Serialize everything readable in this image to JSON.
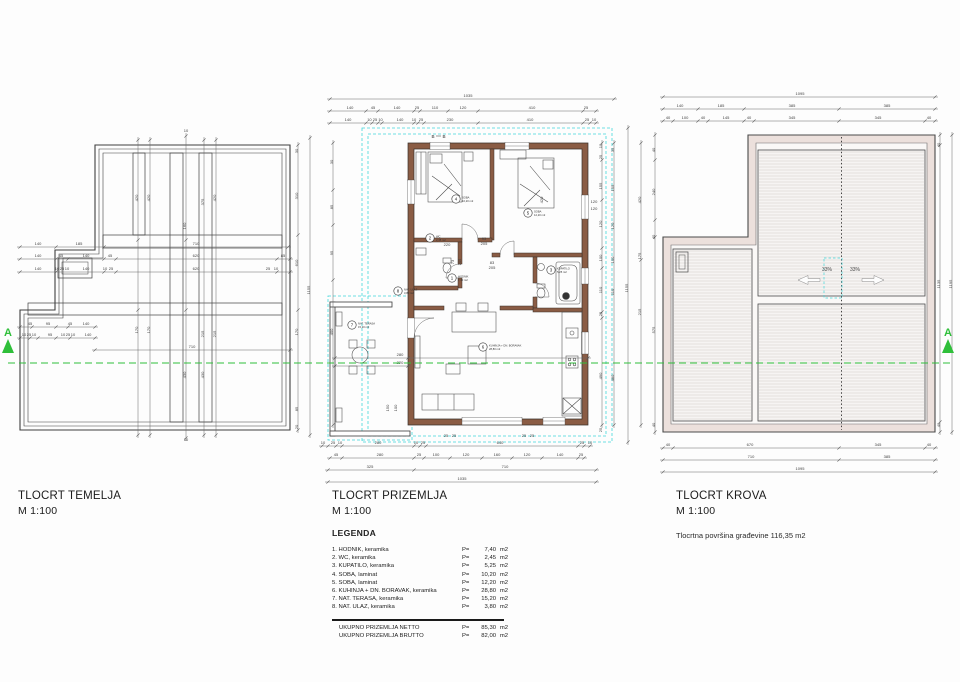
{
  "section": {
    "marker_left": "A",
    "marker_right": "A"
  },
  "plans": {
    "temelja": {
      "title": "TLOCRT TEMELJA",
      "scale": "M 1:100"
    },
    "prizemlja": {
      "title": "TLOCRT PRIZEMLJA",
      "scale": "M 1:100"
    },
    "krova": {
      "title": "TLOCRT KROVA",
      "scale": "M 1:100",
      "note": "Tlocrtna površina građevine 116,35 m2"
    }
  },
  "legend": {
    "heading": "LEGENDA",
    "items": [
      {
        "label": "1. HODNIK, keramika",
        "p": "P=",
        "area": "7,40",
        "unit": "m2"
      },
      {
        "label": "2. WC, keramika",
        "p": "P=",
        "area": "2,45",
        "unit": "m2"
      },
      {
        "label": "3. KUPATILO, keramika",
        "p": "P=",
        "area": "5,25",
        "unit": "m2"
      },
      {
        "label": "4. SOBA, laminat",
        "p": "P=",
        "area": "10,20",
        "unit": "m2"
      },
      {
        "label": "5. SOBA, laminat",
        "p": "P=",
        "area": "12,20",
        "unit": "m2"
      },
      {
        "label": "6. KUHINJA + DN. BORAVAK, keramika",
        "p": "P=",
        "area": "28,80",
        "unit": "m2"
      },
      {
        "label": "7. NAT. TERASA, keramika",
        "p": "P=",
        "area": "15,20",
        "unit": "m2"
      },
      {
        "label": "8. NAT. ULAZ, keramika",
        "p": "P=",
        "area": "3,80",
        "unit": "m2"
      }
    ],
    "totals": [
      {
        "label": "UKUPNO PRIZEMLJA NETTO",
        "p": "P=",
        "area": "85,30",
        "unit": "m2"
      },
      {
        "label": "UKUPNO PRIZEMLJA BRUTTO",
        "p": "P=",
        "area": "82,00",
        "unit": "m2"
      }
    ]
  },
  "floor": {
    "marker_b": "B",
    "rooms": [
      {
        "n": "1",
        "name": "HODNIK",
        "area": "7,40 m2",
        "x": 452,
        "y": 278
      },
      {
        "n": "2",
        "name": "WC",
        "area": "2,45 m2",
        "x": 430,
        "y": 238
      },
      {
        "n": "3",
        "name": "KUPATILO",
        "area": "5,25 m2",
        "x": 551,
        "y": 270
      },
      {
        "n": "4",
        "name": "SOBA",
        "area": "10,20 m2",
        "x": 456,
        "y": 199
      },
      {
        "n": "5",
        "name": "SOBA",
        "area": "12,20 m2",
        "x": 528,
        "y": 213
      },
      {
        "n": "6",
        "name": "KUHINJA + DN. BORAVAK",
        "area": "28,80 m2",
        "x": 483,
        "y": 347
      },
      {
        "n": "7",
        "name": "NAT. TERASA",
        "area": "15,20 m2",
        "x": 352,
        "y": 325
      },
      {
        "n": "8",
        "name": "NAT. ULAZ",
        "area": "3,80 m2",
        "x": 398,
        "y": 291
      }
    ]
  },
  "roof": {
    "slope_left": "33%",
    "slope_right": "33%"
  },
  "dims": {
    "temelja": [
      [
        38,
        245,
        "140"
      ],
      [
        79,
        245,
        "185"
      ],
      [
        196,
        245,
        "710"
      ],
      [
        38,
        257,
        "140"
      ],
      [
        61,
        257,
        "45"
      ],
      [
        86,
        257,
        "140"
      ],
      [
        110,
        257,
        "45"
      ],
      [
        196,
        257,
        "620"
      ],
      [
        283,
        257,
        "85"
      ],
      [
        38,
        270,
        "140"
      ],
      [
        57,
        270,
        "10"
      ],
      [
        62,
        270,
        "25"
      ],
      [
        67,
        270,
        "10"
      ],
      [
        86,
        270,
        "140"
      ],
      [
        105,
        270,
        "10"
      ],
      [
        111,
        270,
        "25"
      ],
      [
        196,
        270,
        "620"
      ],
      [
        268,
        270,
        "25"
      ],
      [
        276,
        270,
        "10"
      ],
      [
        30,
        325,
        "45"
      ],
      [
        48,
        325,
        "95"
      ],
      [
        70,
        325,
        "45"
      ],
      [
        86,
        325,
        "140"
      ],
      [
        24,
        336,
        "10"
      ],
      [
        29,
        336,
        "25"
      ],
      [
        34,
        336,
        "10"
      ],
      [
        50,
        336,
        "95"
      ],
      [
        63,
        336,
        "10"
      ],
      [
        68,
        336,
        "25"
      ],
      [
        73,
        336,
        "10"
      ],
      [
        88,
        336,
        "140"
      ],
      [
        192,
        348,
        "710"
      ],
      [
        138,
        198,
        "420",
        1
      ],
      [
        150,
        198,
        "420",
        1
      ],
      [
        204,
        202,
        "375",
        1
      ],
      [
        216,
        198,
        "420",
        1
      ],
      [
        186,
        226,
        "160",
        1
      ],
      [
        138,
        330,
        "170",
        1
      ],
      [
        150,
        330,
        "170",
        1
      ],
      [
        204,
        334,
        "215",
        1
      ],
      [
        216,
        334,
        "215",
        1
      ],
      [
        186,
        375,
        "430",
        1
      ],
      [
        204,
        375,
        "430",
        1
      ],
      [
        298,
        196,
        "310",
        1
      ],
      [
        298,
        263,
        "610",
        1
      ],
      [
        298,
        332,
        "170",
        1
      ],
      [
        298,
        409,
        "85",
        1
      ],
      [
        298,
        151,
        "30",
        1
      ],
      [
        298,
        427,
        "20",
        1
      ],
      [
        310,
        290,
        "1155",
        1
      ],
      [
        186,
        132,
        "10"
      ],
      [
        186,
        441,
        "10"
      ]
    ],
    "prizemlja": [
      [
        468,
        97,
        "1035"
      ],
      [
        350,
        109,
        "140"
      ],
      [
        373,
        109,
        "45"
      ],
      [
        397,
        109,
        "140"
      ],
      [
        417,
        109,
        "25"
      ],
      [
        435,
        109,
        "110"
      ],
      [
        463,
        109,
        "120"
      ],
      [
        532,
        109,
        "410"
      ],
      [
        586,
        109,
        "25"
      ],
      [
        348,
        121,
        "140"
      ],
      [
        375,
        121,
        "10 25 10"
      ],
      [
        400,
        121,
        "140"
      ],
      [
        414,
        121,
        "10"
      ],
      [
        421,
        121,
        "25"
      ],
      [
        450,
        121,
        "230"
      ],
      [
        530,
        121,
        "410"
      ],
      [
        587,
        121,
        "25"
      ],
      [
        594,
        121,
        "10"
      ],
      [
        323,
        444,
        "10"
      ],
      [
        333,
        444,
        "25"
      ],
      [
        340,
        444,
        "10"
      ],
      [
        378,
        444,
        "280"
      ],
      [
        416,
        444,
        "10"
      ],
      [
        423,
        444,
        "25"
      ],
      [
        500,
        444,
        "640"
      ],
      [
        582,
        444,
        "25"
      ],
      [
        590,
        444,
        "10"
      ],
      [
        336,
        456,
        "45"
      ],
      [
        380,
        456,
        "280"
      ],
      [
        419,
        456,
        "25"
      ],
      [
        436,
        456,
        "100"
      ],
      [
        466,
        456,
        "120"
      ],
      [
        497,
        456,
        "160"
      ],
      [
        527,
        456,
        "120"
      ],
      [
        560,
        456,
        "140"
      ],
      [
        581,
        456,
        "25"
      ],
      [
        370,
        468,
        "325"
      ],
      [
        505,
        468,
        "710"
      ],
      [
        462,
        480,
        "1035"
      ],
      [
        446,
        437,
        "25"
      ],
      [
        454,
        437,
        "25"
      ],
      [
        524,
        437,
        "25"
      ],
      [
        532,
        437,
        "25"
      ],
      [
        602,
        146,
        "10",
        1
      ],
      [
        602,
        157,
        "25",
        1
      ],
      [
        602,
        186,
        "155",
        1
      ],
      [
        602,
        224,
        "120",
        1
      ],
      [
        602,
        258,
        "100",
        1
      ],
      [
        602,
        290,
        "110",
        1
      ],
      [
        602,
        314,
        "25",
        1
      ],
      [
        602,
        376,
        "490",
        1
      ],
      [
        602,
        430,
        "25",
        1
      ],
      [
        614,
        150,
        "35",
        1
      ],
      [
        614,
        188,
        "155",
        1
      ],
      [
        614,
        226,
        "120",
        1
      ],
      [
        614,
        260,
        "100",
        1
      ],
      [
        614,
        292,
        "110",
        1
      ],
      [
        614,
        378,
        "480",
        1
      ],
      [
        628,
        288,
        "1155",
        1
      ],
      [
        641,
        200,
        "420",
        1
      ],
      [
        641,
        256,
        "175",
        1
      ],
      [
        641,
        312,
        "215",
        1
      ],
      [
        333,
        162,
        "30",
        1
      ],
      [
        333,
        207,
        "85",
        1
      ],
      [
        333,
        253,
        "95",
        1
      ],
      [
        333,
        332,
        "400",
        1
      ],
      [
        447,
        246,
        "220"
      ],
      [
        543,
        200,
        "420",
        1
      ],
      [
        594,
        203,
        "120"
      ],
      [
        594,
        210,
        "120"
      ],
      [
        400,
        356,
        "280"
      ],
      [
        400,
        364,
        "220"
      ],
      [
        389,
        408,
        "150",
        1
      ],
      [
        397,
        408,
        "100",
        1
      ],
      [
        484,
        240,
        "93"
      ],
      [
        484,
        245,
        "205"
      ],
      [
        492,
        264,
        "83"
      ],
      [
        492,
        269,
        "205"
      ],
      [
        454,
        262,
        "73",
        1
      ],
      [
        461,
        262,
        "205",
        1
      ]
    ],
    "krova": [
      [
        800,
        95,
        "1095"
      ],
      [
        680,
        107,
        "140"
      ],
      [
        721,
        107,
        "185"
      ],
      [
        792,
        107,
        "385"
      ],
      [
        887,
        107,
        "385"
      ],
      [
        668,
        119,
        "40"
      ],
      [
        685,
        119,
        "100"
      ],
      [
        703,
        119,
        "40"
      ],
      [
        726,
        119,
        "145"
      ],
      [
        749,
        119,
        "40"
      ],
      [
        792,
        119,
        "345"
      ],
      [
        878,
        119,
        "345"
      ],
      [
        929,
        119,
        "40"
      ],
      [
        668,
        446,
        "40"
      ],
      [
        750,
        446,
        "670"
      ],
      [
        878,
        446,
        "345"
      ],
      [
        929,
        446,
        "40"
      ],
      [
        751,
        458,
        "710"
      ],
      [
        887,
        458,
        "385"
      ],
      [
        800,
        470,
        "1095"
      ],
      [
        655,
        150,
        "40",
        1
      ],
      [
        655,
        192,
        "240",
        1
      ],
      [
        655,
        237,
        "40",
        1
      ],
      [
        655,
        330,
        "575",
        1
      ],
      [
        655,
        425,
        "40",
        1
      ],
      [
        940,
        145,
        "40",
        1
      ],
      [
        940,
        284,
        "1135",
        1
      ],
      [
        940,
        425,
        "40",
        1
      ],
      [
        952,
        284,
        "1195",
        1
      ]
    ]
  }
}
